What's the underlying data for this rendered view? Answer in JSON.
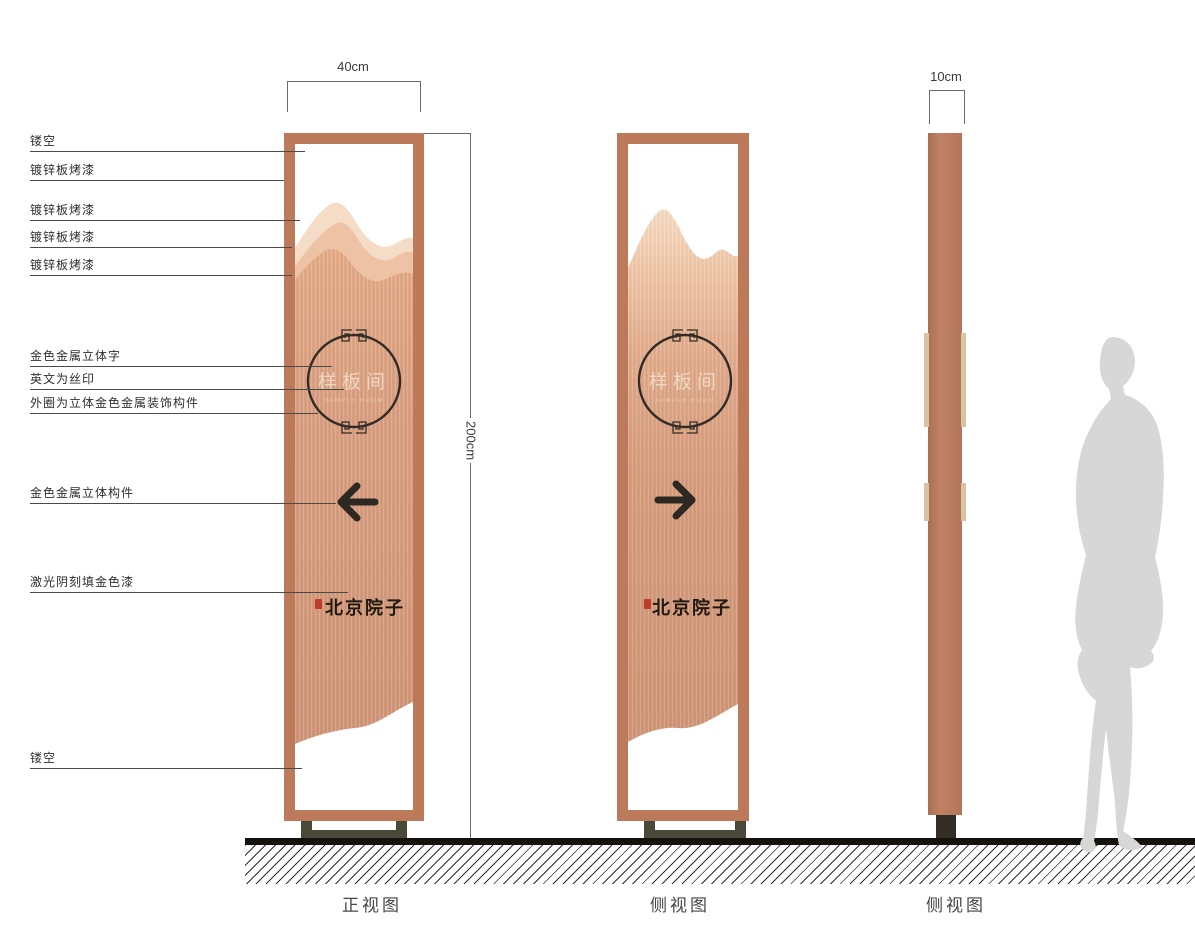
{
  "annotations": [
    {
      "text": "镂空"
    },
    {
      "text": "镀锌板烤漆"
    },
    {
      "text": "镀锌板烤漆"
    },
    {
      "text": "镀锌板烤漆"
    },
    {
      "text": "镀锌板烤漆"
    },
    {
      "text": "金色金属立体字"
    },
    {
      "text": "英文为丝印"
    },
    {
      "text": "外圈为立体金色金属装饰构件"
    },
    {
      "text": "金色金属立体构件"
    },
    {
      "text": "激光阴刻填金色漆"
    },
    {
      "text": "镂空"
    }
  ],
  "dimensions": {
    "front_width": "40cm",
    "height": "200cm",
    "side_width": "10cm"
  },
  "signage": {
    "circle_text": "样板间",
    "english_subtext": "SAMPLE ROOM",
    "logo_text": "北京院子"
  },
  "captions": {
    "front_view": "正视图",
    "side_view_1": "侧视图",
    "side_view_2": "侧视图"
  },
  "colors": {
    "frame_copper": "#bc7a5b",
    "panel_copper": "#d59c7d",
    "mountain_light": "#f5dcc6",
    "mountain_mid": "#eec2a4",
    "line_dark": "#332c26",
    "seal_red": "#bf3b2a",
    "base_olive": "#4a4838",
    "silhouette_gray": "#d7d7d7"
  }
}
